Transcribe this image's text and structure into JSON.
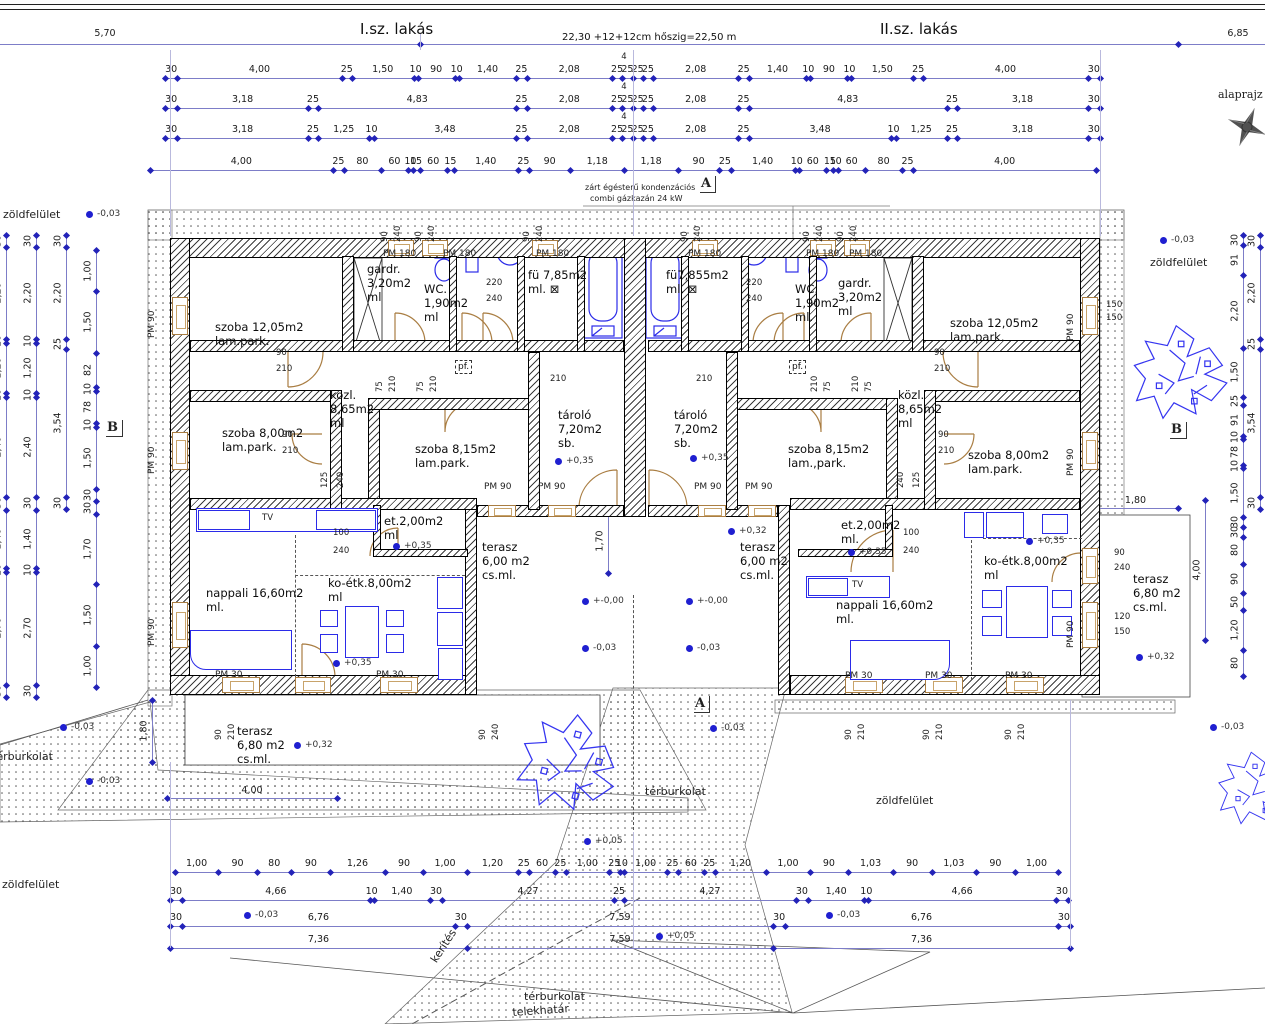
{
  "header": {
    "left_dim": "5,70",
    "apt1": "I.sz. lakás",
    "total": "22,30 +12+12cm hőszig=22,50 m",
    "apt2": "II.sz. lakás",
    "right_dim": "6,85",
    "plan_label": "alaprajz"
  },
  "boiler_note": {
    "line1": "zárt égésterű kondenzációs",
    "line2": "combi gázkazán  24 kW"
  },
  "four_note": "4",
  "dim_rows": [
    {
      "y": 78,
      "x1": 165,
      "x2": 1100,
      "note_x": 624,
      "items": [
        "30",
        "4,00",
        "25",
        "1,50",
        "10",
        "90",
        "10",
        "1,40",
        "25",
        "2,08",
        "25",
        "25",
        "25",
        "25",
        "2,08",
        "25",
        "1,40",
        "10",
        "90",
        "10",
        "1,50",
        "25",
        "4,00",
        "30"
      ]
    },
    {
      "y": 108,
      "x1": 165,
      "x2": 1100,
      "note_x": 624,
      "items": [
        "30",
        "3,18",
        "25",
        "4,83",
        "25",
        "2,08",
        "25",
        "25",
        "25",
        "25",
        "2,08",
        "25",
        "4,83",
        "25",
        "3,18",
        "30"
      ]
    },
    {
      "y": 138,
      "x1": 165,
      "x2": 1100,
      "note_x": 624,
      "items": [
        "30",
        "3,18",
        "25",
        "1,25",
        "10",
        "3,48",
        "25",
        "2,08",
        "25",
        "25",
        "25",
        "25",
        "2,08",
        "25",
        "3,48",
        "10",
        "1,25",
        "25",
        "3,18",
        "30"
      ]
    },
    {
      "y": 170,
      "x1": 150,
      "x2": 1096,
      "items": [
        "4,00",
        "25",
        "80",
        "60",
        "10",
        "15",
        "60",
        "15",
        "1,40",
        "25",
        "90",
        "1,18",
        "1,18",
        "90",
        "25",
        "1,40",
        "10",
        "60",
        "15",
        "10",
        "60",
        "80",
        "25",
        "4,00"
      ]
    },
    {
      "y": 872,
      "x1": 175,
      "x2": 1058,
      "items": [
        "1,00",
        "90",
        "80",
        "90",
        "1,26",
        "90",
        "1,00",
        "1,20",
        "25",
        "60",
        "25",
        "1,00",
        "25",
        "10",
        "1,00",
        "25",
        "60",
        "25",
        "1,20",
        "1,00",
        "90",
        "1,03",
        "90",
        "1,03",
        "90",
        "1,00"
      ]
    },
    {
      "y": 900,
      "x1": 170,
      "x2": 1068,
      "items": [
        "30",
        "4,66",
        "10",
        "1,40",
        "30",
        "4,27",
        "25",
        "4,27",
        "30",
        "1,40",
        "10",
        "4,66",
        "30"
      ]
    },
    {
      "y": 926,
      "x1": 170,
      "x2": 1070,
      "items": [
        "30",
        "6,76",
        "30",
        "7,59",
        "30",
        "6,76",
        "30"
      ]
    },
    {
      "y": 948,
      "x1": 170,
      "x2": 1070,
      "items": [
        "7,36",
        "7,59",
        "7,36"
      ]
    }
  ],
  "vchains": [
    {
      "x": 6,
      "y1": 235,
      "y2": 697,
      "items": [
        "30",
        "2,20",
        "10",
        "1,20",
        "10",
        "2,40",
        "30",
        "1,40",
        "10",
        "2,70",
        "30"
      ]
    },
    {
      "x": 36,
      "y1": 235,
      "y2": 697,
      "items": [
        "30",
        "2,20",
        "10",
        "1,20",
        "10",
        "2,40",
        "30",
        "1,40",
        "10",
        "2,70",
        "30"
      ]
    },
    {
      "x": 66,
      "y1": 235,
      "y2": 509,
      "items": [
        "30",
        "2,20",
        "25",
        "3,54",
        "30"
      ]
    },
    {
      "x": 96,
      "y1": 250,
      "y2": 687,
      "items": [
        "1,00",
        "1,50",
        "82",
        "10",
        "78",
        "10",
        "1,50",
        "30",
        "30",
        "1,70",
        "1,50",
        "1,00"
      ]
    },
    {
      "x": 1243,
      "y1": 235,
      "y2": 676,
      "items": [
        "30",
        "91",
        "2,20",
        "1,50",
        "25",
        "91",
        "10",
        "78",
        "10",
        "1,50",
        "30",
        "30",
        "80",
        "90",
        "50",
        "1,20",
        "80"
      ]
    },
    {
      "x": 1260,
      "y1": 235,
      "y2": 509,
      "items": [
        "30",
        "2,20",
        "25",
        "3,54",
        "30"
      ]
    }
  ],
  "extra_dims": [
    {
      "t": "4,00",
      "x1": 167,
      "y1": 798,
      "x2": 337,
      "y2": 798
    },
    {
      "t": "4,00",
      "x1": 1205,
      "y1": 500,
      "x2": 1205,
      "y2": 640
    },
    {
      "t": "1,80",
      "x1": 152,
      "y1": 700,
      "x2": 152,
      "y2": 762
    },
    {
      "t": "1,80",
      "x1": 1093,
      "y1": 508,
      "x2": 1178,
      "y2": 508
    },
    {
      "t": "1,70",
      "x1": 608,
      "y1": 508,
      "x2": 608,
      "y2": 573
    }
  ],
  "rooms": [
    {
      "x": 215,
      "y": 320,
      "lines": [
        "szoba 12,05m2",
        "lam.park."
      ]
    },
    {
      "x": 367,
      "y": 262,
      "lines": [
        "gardr.",
        "3,20m2",
        "ml"
      ]
    },
    {
      "x": 424,
      "y": 282,
      "lines": [
        "WC.",
        "1,90m2",
        "ml"
      ]
    },
    {
      "x": 528,
      "y": 268,
      "lines": [
        "fü 7,85m2",
        "ml. ⊠"
      ]
    },
    {
      "x": 666,
      "y": 268,
      "lines": [
        "fü7,855m2",
        "ml. ⊠"
      ]
    },
    {
      "x": 795,
      "y": 282,
      "lines": [
        "WC.",
        "1,90m2",
        "ml."
      ]
    },
    {
      "x": 838,
      "y": 276,
      "lines": [
        "gardr.",
        "3,20m2",
        "ml"
      ]
    },
    {
      "x": 950,
      "y": 316,
      "lines": [
        "szoba 12,05m2",
        "lam.park."
      ]
    },
    {
      "x": 330,
      "y": 388,
      "lines": [
        "közl.",
        "8,65m2",
        "ml"
      ]
    },
    {
      "x": 898,
      "y": 388,
      "lines": [
        "közl.",
        "8,65m2",
        "ml"
      ]
    },
    {
      "x": 222,
      "y": 426,
      "lines": [
        "szoba 8,00m2",
        "lam.park."
      ]
    },
    {
      "x": 968,
      "y": 448,
      "lines": [
        "szoba 8,00m2",
        "lam.park."
      ]
    },
    {
      "x": 415,
      "y": 442,
      "lines": [
        "szoba 8,15m2",
        "lam.park."
      ]
    },
    {
      "x": 788,
      "y": 442,
      "lines": [
        "szoba 8,15m2",
        "lam.,park."
      ]
    },
    {
      "x": 558,
      "y": 408,
      "lines": [
        "tároló",
        "7,20m2",
        "sb."
      ]
    },
    {
      "x": 674,
      "y": 408,
      "lines": [
        "tároló",
        "7,20m2",
        "sb."
      ]
    },
    {
      "x": 384,
      "y": 514,
      "lines": [
        "et.2,00m2",
        "ml"
      ]
    },
    {
      "x": 841,
      "y": 518,
      "lines": [
        "et.2,00m2",
        "ml."
      ]
    },
    {
      "x": 206,
      "y": 586,
      "lines": [
        "nappali 16,60m2",
        "ml."
      ]
    },
    {
      "x": 836,
      "y": 598,
      "lines": [
        "nappali 16,60m2",
        "ml."
      ]
    },
    {
      "x": 328,
      "y": 576,
      "lines": [
        "ko-étk.8,00m2",
        "ml"
      ]
    },
    {
      "x": 984,
      "y": 554,
      "lines": [
        "ko-étk.8,00m2",
        "ml"
      ]
    },
    {
      "x": 482,
      "y": 540,
      "lines": [
        "terasz",
        "6,00 m2",
        "cs.ml."
      ]
    },
    {
      "x": 740,
      "y": 540,
      "lines": [
        "terasz",
        "6,00 m2",
        "cs.ml."
      ]
    },
    {
      "x": 237,
      "y": 724,
      "lines": [
        "terasz",
        "6,80 m2",
        "cs.ml."
      ]
    },
    {
      "x": 1133,
      "y": 572,
      "lines": [
        "terasz",
        "6,80 m2",
        "cs.ml."
      ]
    }
  ],
  "markers": [
    {
      "t": "-0,03",
      "x": 86,
      "y": 211
    },
    {
      "t": "-0,03",
      "x": 1160,
      "y": 237
    },
    {
      "t": "+0,35",
      "x": 555,
      "y": 458
    },
    {
      "t": "+0,35",
      "x": 690,
      "y": 455
    },
    {
      "t": "+0,32",
      "x": 728,
      "y": 528
    },
    {
      "t": "+0,35",
      "x": 393,
      "y": 543
    },
    {
      "t": "+0,35",
      "x": 848,
      "y": 549
    },
    {
      "t": "+0,35",
      "x": 333,
      "y": 660
    },
    {
      "t": "+0,35",
      "x": 1026,
      "y": 538
    },
    {
      "t": "+-0,00",
      "x": 582,
      "y": 598
    },
    {
      "t": "+-0,00",
      "x": 686,
      "y": 598
    },
    {
      "t": "-0,03",
      "x": 582,
      "y": 645
    },
    {
      "t": "-0,03",
      "x": 686,
      "y": 645
    },
    {
      "t": "+0,32",
      "x": 294,
      "y": 742
    },
    {
      "t": "+0,32",
      "x": 1136,
      "y": 654
    },
    {
      "t": "-0,03",
      "x": 60,
      "y": 724
    },
    {
      "t": "-0,03",
      "x": 86,
      "y": 778
    },
    {
      "t": "-0,03",
      "x": 710,
      "y": 725
    },
    {
      "t": "-0,03",
      "x": 1210,
      "y": 724
    },
    {
      "t": "-0,03",
      "x": 244,
      "y": 912
    },
    {
      "t": "-0,03",
      "x": 826,
      "y": 912
    },
    {
      "t": "+0,05",
      "x": 584,
      "y": 838
    },
    {
      "t": "+0,05",
      "x": 656,
      "y": 933
    }
  ],
  "pm_labels": [
    {
      "t": "PM 180",
      "x": 383,
      "y": 249
    },
    {
      "t": "PM 180",
      "x": 443,
      "y": 249
    },
    {
      "t": "PM 180",
      "x": 536,
      "y": 249
    },
    {
      "t": "PM 180",
      "x": 688,
      "y": 249
    },
    {
      "t": "PM 180",
      "x": 806,
      "y": 249
    },
    {
      "t": "PM 180",
      "x": 849,
      "y": 249
    },
    {
      "t": "PM 90",
      "x": 484,
      "y": 482
    },
    {
      "t": "PM 90",
      "x": 538,
      "y": 482
    },
    {
      "t": "PM 90",
      "x": 694,
      "y": 482
    },
    {
      "t": "PM 90",
      "x": 745,
      "y": 482
    },
    {
      "t": "PM 30",
      "x": 215,
      "y": 670
    },
    {
      "t": "PM 30",
      "x": 376,
      "y": 670
    },
    {
      "t": "PM 30",
      "x": 845,
      "y": 671
    },
    {
      "t": "PM 30",
      "x": 925,
      "y": 671
    },
    {
      "t": "PM 30",
      "x": 1005,
      "y": 671
    },
    {
      "t": "PM 90",
      "x": 157,
      "y": 328,
      "r": 1
    },
    {
      "t": "PM 90",
      "x": 157,
      "y": 464,
      "r": 1
    },
    {
      "t": "PM 90",
      "x": 157,
      "y": 636,
      "r": 1
    },
    {
      "t": "PM 90",
      "x": 1076,
      "y": 331,
      "r": 1
    },
    {
      "t": "PM 90",
      "x": 1076,
      "y": 466,
      "r": 1
    },
    {
      "t": "PM 90",
      "x": 1076,
      "y": 638,
      "r": 1
    }
  ],
  "small_dims": [
    {
      "t": "220",
      "x": 486,
      "y": 278
    },
    {
      "t": "240",
      "x": 486,
      "y": 294
    },
    {
      "t": "220",
      "x": 746,
      "y": 278
    },
    {
      "t": "240",
      "x": 746,
      "y": 294
    },
    {
      "t": "100",
      "x": 333,
      "y": 528
    },
    {
      "t": "240",
      "x": 333,
      "y": 546
    },
    {
      "t": "100",
      "x": 903,
      "y": 528
    },
    {
      "t": "240",
      "x": 903,
      "y": 546
    },
    {
      "t": "90",
      "x": 276,
      "y": 348
    },
    {
      "t": "210",
      "x": 276,
      "y": 364
    },
    {
      "t": "90",
      "x": 934,
      "y": 348
    },
    {
      "t": "210",
      "x": 934,
      "y": 364
    },
    {
      "t": "90",
      "x": 282,
      "y": 430
    },
    {
      "t": "210",
      "x": 282,
      "y": 446
    },
    {
      "t": "90",
      "x": 938,
      "y": 430
    },
    {
      "t": "210",
      "x": 938,
      "y": 446
    },
    {
      "t": "210",
      "x": 550,
      "y": 374
    },
    {
      "t": "210",
      "x": 696,
      "y": 374
    },
    {
      "t": "125",
      "x": 330,
      "y": 478,
      "r": 1
    },
    {
      "t": "240",
      "x": 346,
      "y": 478,
      "r": 1
    },
    {
      "t": "240",
      "x": 906,
      "y": 478,
      "r": 1
    },
    {
      "t": "125",
      "x": 922,
      "y": 478,
      "r": 1
    },
    {
      "t": "75",
      "x": 385,
      "y": 382,
      "r": 1
    },
    {
      "t": "210",
      "x": 398,
      "y": 382,
      "r": 1
    },
    {
      "t": "75",
      "x": 426,
      "y": 382,
      "r": 1
    },
    {
      "t": "210",
      "x": 439,
      "y": 382,
      "r": 1
    },
    {
      "t": "210",
      "x": 820,
      "y": 382,
      "r": 1
    },
    {
      "t": "75",
      "x": 833,
      "y": 382,
      "r": 1
    },
    {
      "t": "210",
      "x": 861,
      "y": 382,
      "r": 1
    },
    {
      "t": "75",
      "x": 874,
      "y": 382,
      "r": 1
    },
    {
      "t": "90",
      "x": 390,
      "y": 232,
      "r": 1
    },
    {
      "t": "240",
      "x": 403,
      "y": 232,
      "r": 1
    },
    {
      "t": "90",
      "x": 424,
      "y": 232,
      "r": 1
    },
    {
      "t": "240",
      "x": 437,
      "y": 232,
      "r": 1
    },
    {
      "t": "90",
      "x": 532,
      "y": 232,
      "r": 1
    },
    {
      "t": "240",
      "x": 545,
      "y": 232,
      "r": 1
    },
    {
      "t": "90",
      "x": 690,
      "y": 232,
      "r": 1
    },
    {
      "t": "240",
      "x": 703,
      "y": 232,
      "r": 1
    },
    {
      "t": "90",
      "x": 812,
      "y": 232,
      "r": 1
    },
    {
      "t": "240",
      "x": 825,
      "y": 232,
      "r": 1
    },
    {
      "t": "90",
      "x": 846,
      "y": 232,
      "r": 1
    },
    {
      "t": "240",
      "x": 859,
      "y": 232,
      "r": 1
    },
    {
      "t": "90",
      "x": 224,
      "y": 730,
      "r": 1
    },
    {
      "t": "210",
      "x": 237,
      "y": 730,
      "r": 1
    },
    {
      "t": "90",
      "x": 488,
      "y": 730,
      "r": 1
    },
    {
      "t": "240",
      "x": 501,
      "y": 730,
      "r": 1
    },
    {
      "t": "90",
      "x": 854,
      "y": 730,
      "r": 1
    },
    {
      "t": "210",
      "x": 867,
      "y": 730,
      "r": 1
    },
    {
      "t": "90",
      "x": 932,
      "y": 730,
      "r": 1
    },
    {
      "t": "210",
      "x": 945,
      "y": 730,
      "r": 1
    },
    {
      "t": "90",
      "x": 1014,
      "y": 730,
      "r": 1
    },
    {
      "t": "210",
      "x": 1027,
      "y": 730,
      "r": 1
    },
    {
      "t": "150",
      "x": 1106,
      "y": 300
    },
    {
      "t": "150",
      "x": 1106,
      "y": 313
    },
    {
      "t": "90",
      "x": 1114,
      "y": 548
    },
    {
      "t": "240",
      "x": 1114,
      "y": 563
    },
    {
      "t": "120",
      "x": 1114,
      "y": 612
    },
    {
      "t": "150",
      "x": 1114,
      "y": 627
    },
    {
      "t": "pf.",
      "x": 455,
      "y": 360,
      "box": 1
    },
    {
      "t": "pf.",
      "x": 789,
      "y": 360,
      "box": 1
    },
    {
      "t": "TV",
      "x": 262,
      "y": 513
    },
    {
      "t": "TV",
      "x": 852,
      "y": 580
    }
  ],
  "site_labels": [
    {
      "t": "zöldfelület",
      "x": 3,
      "y": 208
    },
    {
      "t": "zöldfelület",
      "x": 1150,
      "y": 256
    },
    {
      "t": "zöldfelület",
      "x": 876,
      "y": 794
    },
    {
      "t": "zöldfelület",
      "x": 2,
      "y": 878
    },
    {
      "t": "térburkolat",
      "x": -8,
      "y": 750
    },
    {
      "t": "térburkolat",
      "x": 645,
      "y": 785
    },
    {
      "t": "térburkolat",
      "x": 524,
      "y": 990
    },
    {
      "t": "telekhatár",
      "x": 512,
      "y": 1006,
      "rot": -4
    },
    {
      "t": "kerítés",
      "x": 428,
      "y": 958,
      "rot": -57
    }
  ],
  "section_marks": [
    {
      "t": "A",
      "x": 700,
      "y": 176
    },
    {
      "t": "A",
      "x": 694,
      "y": 696
    },
    {
      "t": "B",
      "x": 106,
      "y": 420
    },
    {
      "t": "B",
      "x": 1170,
      "y": 422
    }
  ]
}
